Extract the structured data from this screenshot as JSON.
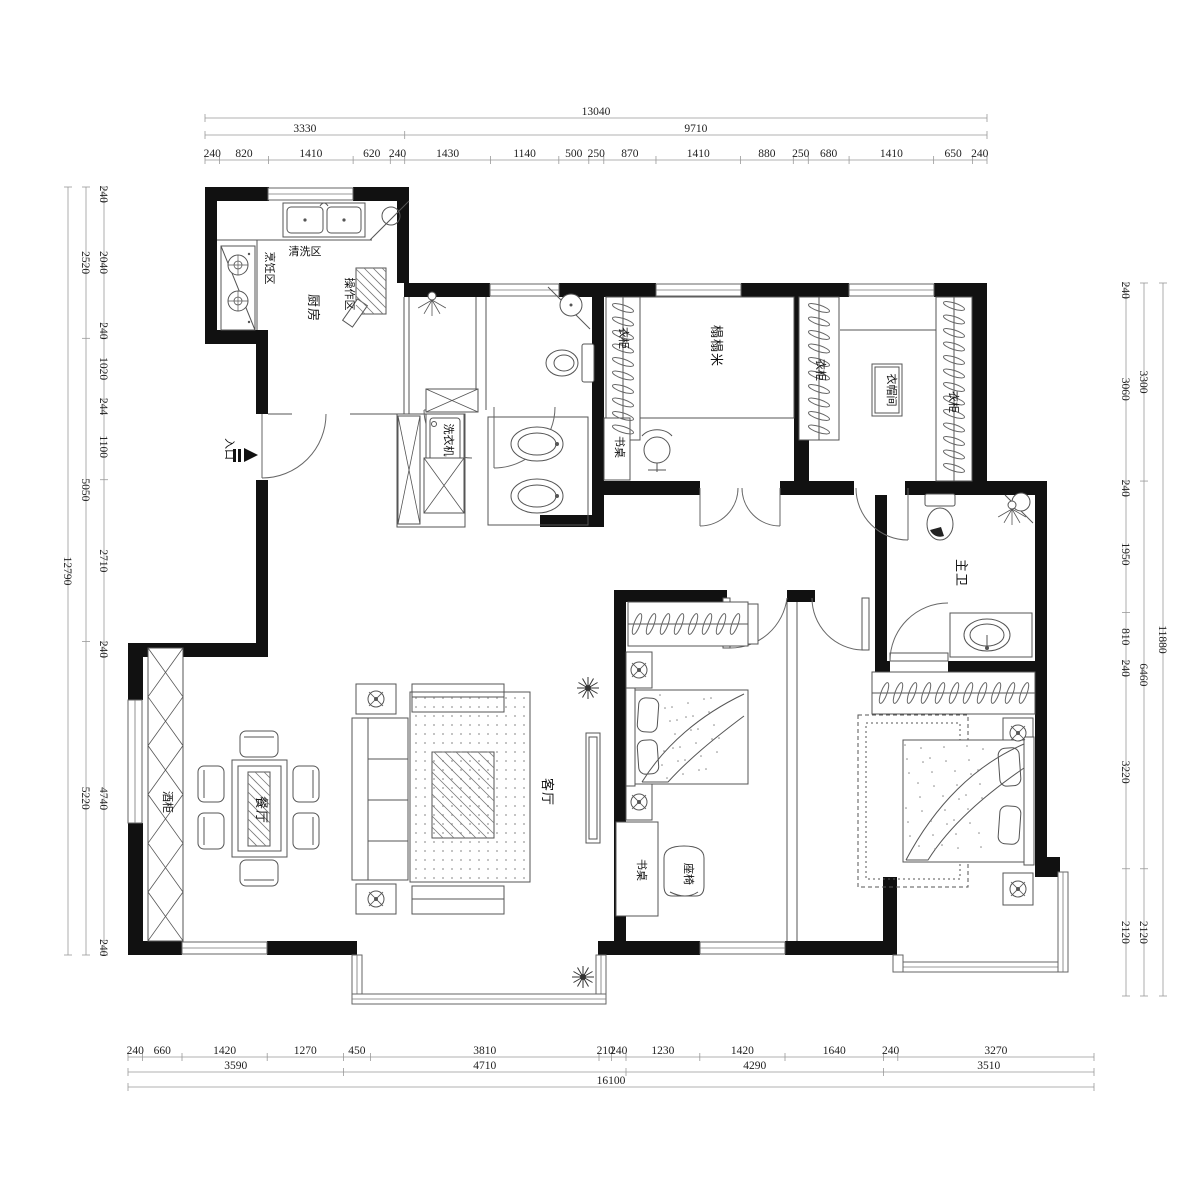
{
  "drawing": {
    "type": "apartment-floor-plan",
    "wall_color": "#111111",
    "line_color": "#555555",
    "dim_text_color": "#222222"
  },
  "labels": {
    "kitchen": "厨房",
    "wash_area": "清洗区",
    "cook_area": "烹饪区",
    "prep_area": "操作区",
    "washer": "洗衣机",
    "tatami": "榻榻米",
    "tatami_wardrobe": "衣柜",
    "tatami_desk": "书桌",
    "mid_wardrobe": "衣柜",
    "closet_wardrobe": "衣柜",
    "cloakroom": "衣帽间",
    "master_bath": "主卫",
    "living_room": "客厅",
    "dining_room": "餐厅",
    "wine_cabinet": "酒柜",
    "bedroom_desk": "书桌",
    "bedroom_chair": "座椅",
    "entry": "入口"
  },
  "dimensions": {
    "top": {
      "row_total": [
        13040
      ],
      "row_mid": [
        3330,
        9710
      ],
      "row_detail": [
        240,
        820,
        1410,
        620,
        240,
        1430,
        1140,
        500,
        250,
        870,
        1410,
        880,
        250,
        680,
        1410,
        650,
        240
      ]
    },
    "left": {
      "inner": [
        240,
        2040,
        240,
        1020,
        244,
        1100,
        2710,
        240,
        4740,
        240
      ],
      "middle": [
        2520,
        5050,
        5220
      ],
      "outer": [
        12790
      ]
    },
    "right": {
      "inner": [
        240,
        3060,
        240,
        1950,
        810,
        240,
        3220,
        2120
      ],
      "middle": [
        3300,
        6460,
        2120
      ],
      "outer": [
        11880
      ]
    },
    "bottom": {
      "row_detail": [
        240,
        660,
        1420,
        1270,
        450,
        3810,
        210,
        240,
        1230,
        1420,
        1640,
        240,
        3270
      ],
      "row_mid": [
        3590,
        4710,
        4290,
        3510
      ],
      "row_total": [
        16100
      ]
    }
  }
}
